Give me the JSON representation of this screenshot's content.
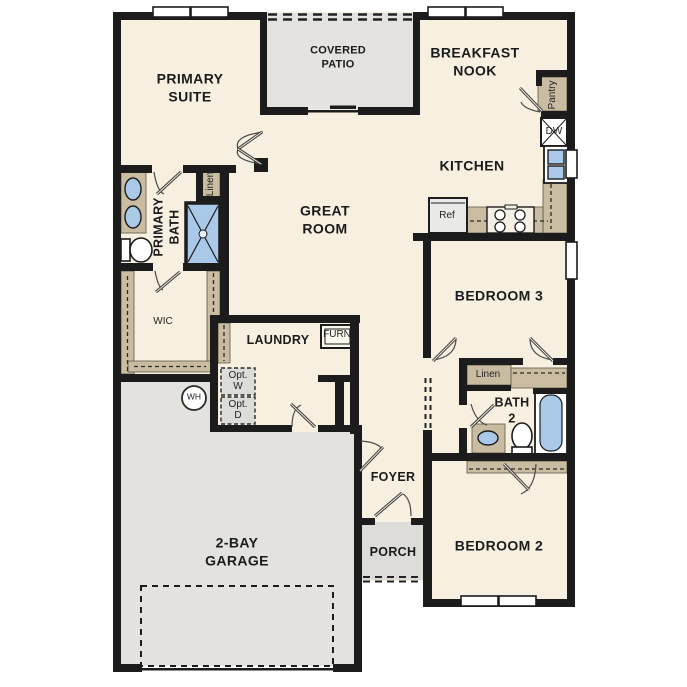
{
  "plan": {
    "type": "single-story floor plan",
    "rooms": {
      "primary_suite": [
        "PRIMARY",
        "SUITE"
      ],
      "covered_patio": [
        "COVERED",
        "PATIO"
      ],
      "breakfast_nook": [
        "BREAKFAST",
        "NOOK"
      ],
      "kitchen": "KITCHEN",
      "great_room": [
        "GREAT",
        "ROOM"
      ],
      "primary_bath": [
        "PRIMARY",
        "BATH"
      ],
      "wic": "WIC",
      "laundry": "LAUNDRY",
      "bedroom_3": "BEDROOM 3",
      "bath_2": [
        "BATH",
        "2"
      ],
      "bedroom_2": "BEDROOM 2",
      "foyer": "FOYER",
      "porch": "PORCH",
      "garage": [
        "2-BAY",
        "GARAGE"
      ]
    },
    "closets": {
      "pantry": "Pantry",
      "linen_primary": "Linen",
      "linen_hall": "Linen"
    },
    "appliances": {
      "dishwasher": "DW",
      "refrigerator": "Ref",
      "furnace": "FURN",
      "water_heater": "WH",
      "optional_washer": [
        "Opt.",
        "W"
      ],
      "optional_dryer": [
        "Opt.",
        "D"
      ]
    },
    "colors": {
      "wall": "#1c1c1c",
      "floor_cream": "#f7efe0",
      "patio_gray": "#e4e3e0",
      "garage_gray": "#e3e2df",
      "porch_gray": "#dddcd9",
      "cabinet_tan": "#c9bca1",
      "fixture_blue": "#aac8e8",
      "appliance_gray": "#dcdcd9"
    }
  }
}
